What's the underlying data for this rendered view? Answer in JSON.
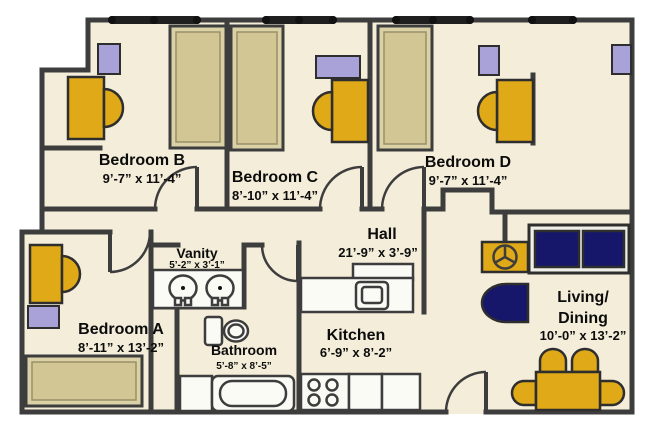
{
  "colors": {
    "floor": "#f3edd9",
    "wall": "#3d3d3d",
    "gold": "#dfa917",
    "navy": "#16166b",
    "lavender": "#a8a2d8",
    "bed_outer": "#dbd1a6",
    "bed_inner": "#d2c694",
    "fixture": "#fbfbf6",
    "window": "#1f1f1f"
  },
  "rooms": {
    "bedroom_b": {
      "name": "Bedroom B",
      "dims": "9’-7” x 11’-4”"
    },
    "bedroom_c": {
      "name": "Bedroom C",
      "dims": "8’-10” x 11’-4”"
    },
    "bedroom_d": {
      "name": "Bedroom D",
      "dims": "9’-7” x 11’-4”"
    },
    "bedroom_a": {
      "name": "Bedroom A",
      "dims": "8’-11” x 13’-2”"
    },
    "vanity": {
      "name": "Vanity",
      "dims": "5’-2” x 3’-1”"
    },
    "hall": {
      "name": "Hall",
      "dims": "21’-9” x 3’-9”"
    },
    "kitchen": {
      "name": "Kitchen",
      "dims": "6’-9” x 8’-2”"
    },
    "bathroom": {
      "name": "Bathroom",
      "dims": "5’-8” x 8’-5”"
    },
    "living_dining": {
      "name1": "Living/",
      "name2": "Dining",
      "dims": "10’-0” x 13’-2”"
    }
  }
}
